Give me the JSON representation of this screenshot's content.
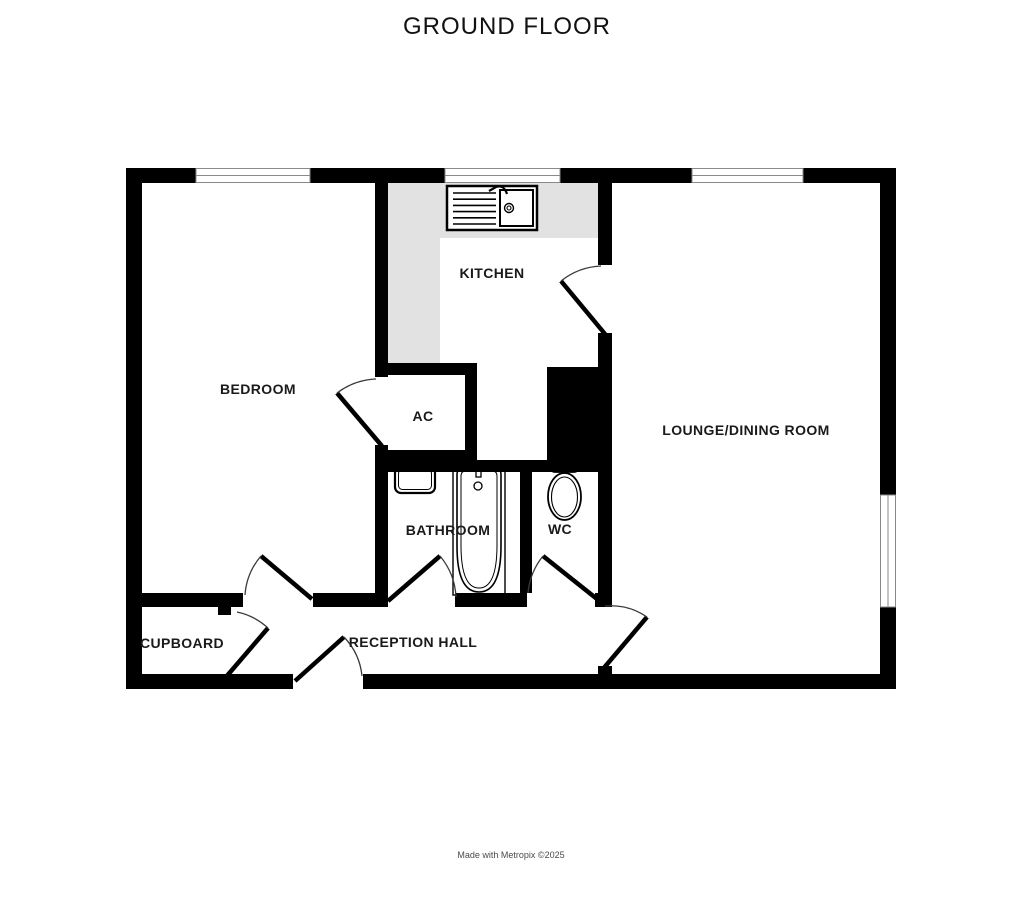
{
  "title": "GROUND FLOOR",
  "footer": "Made with Metropix ©2025",
  "rooms": {
    "bedroom": {
      "label": "BEDROOM"
    },
    "kitchen": {
      "label": "KITCHEN"
    },
    "airing_cupboard": {
      "label": "AC"
    },
    "lounge": {
      "label": "LOUNGE/DINING ROOM"
    },
    "bathroom": {
      "label": "BATHROOM"
    },
    "wc": {
      "label": "WC"
    },
    "cupboard": {
      "label": "CUPBOARD"
    },
    "reception_hall": {
      "label": "RECEPTION HALL"
    }
  },
  "fixtures": [
    "kitchen-sink",
    "bathroom-sink",
    "bath",
    "toilet"
  ],
  "colors": {
    "wall": "#000000",
    "counter": "#e2e2e2",
    "window_frame": "#8a8a8a",
    "door_arc": "#3a3a3a",
    "label_text": "#1a1a1a"
  }
}
